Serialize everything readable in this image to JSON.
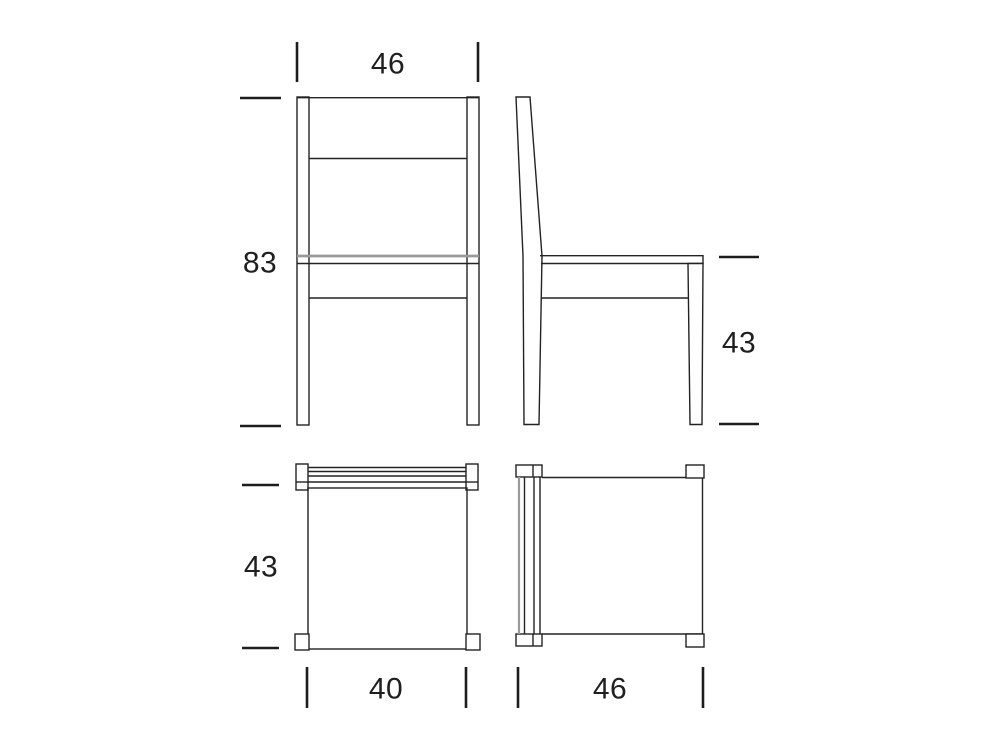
{
  "drawing": {
    "kind": "chair-dimension-diagram",
    "views": {
      "front": "front-view",
      "side": "side-view",
      "top": "top-view",
      "top_rotated": "top-view-rotated"
    }
  },
  "dimensions": {
    "front_width": "46",
    "overall_height": "83",
    "seat_height": "43",
    "top_view_depth": "43",
    "seat_width_bottom": "40",
    "side_depth_bottom": "46"
  },
  "colors": {
    "background": "#ffffff",
    "line": "#232323",
    "gray_line": "#9a9a9a",
    "text": "#1f1f1f"
  }
}
